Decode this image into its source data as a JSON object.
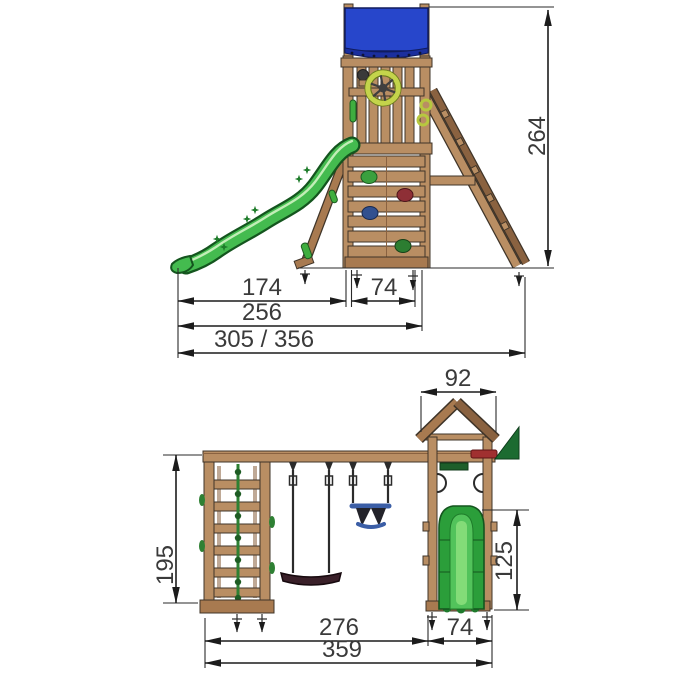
{
  "diagram": {
    "kind": "playground-set-dimension-drawing",
    "views": {
      "side": {
        "dims": {
          "slide_to_tower": "174",
          "tower_depth": "74",
          "slide_to_back": "256",
          "overall_depth": "305 / 356",
          "overall_height": "264"
        }
      },
      "front": {
        "dims": {
          "roof_width": "92",
          "climb_frame_height": "195",
          "platform_height": "125",
          "frame_to_tower": "276",
          "tower_width": "74",
          "overall_width": "359"
        }
      }
    },
    "colors": {
      "canopy_blue": "#2746cb",
      "canopy_blue_dark": "#1b2f9e",
      "slide_green": "#44bb4f",
      "slide_green_dark": "#14551e",
      "slide_green_light": "#7fd96a",
      "flag_green": "#1c6b31",
      "wheel_green": "#c4d44b",
      "wood_light": "#b98e63",
      "wood_mid": "#a87a50",
      "outline": "#3f3428",
      "dim_line": "#1c1c1c",
      "dim_text": "#3a3a3a",
      "hold_green": "#3aa03e",
      "hold_red": "#8e2f36",
      "hold_blue": "#31508f",
      "hold_dark_green": "#2c7d31",
      "swing_seat": "#3a2029",
      "baby_seat_blue": "#3b5ea6"
    }
  }
}
